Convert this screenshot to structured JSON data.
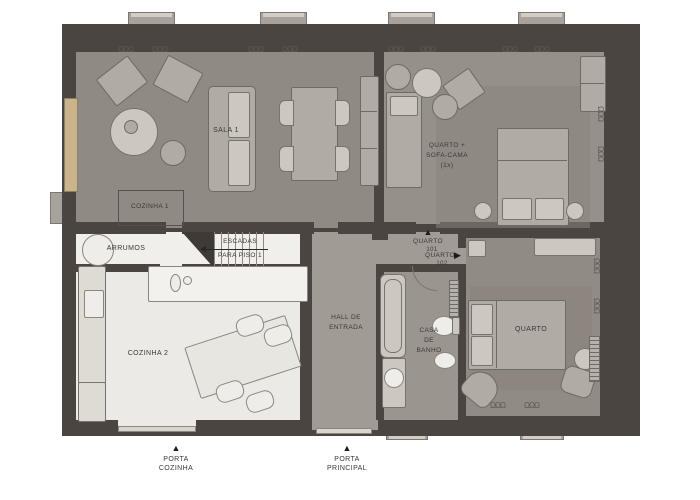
{
  "rooms": {
    "sala1": {
      "label": "SALA 1"
    },
    "cozinha1": {
      "label": "COZINHA 1"
    },
    "arrumos": {
      "label": "ARRUMOS"
    },
    "escadas": {
      "line1": "ESCADAS",
      "line2": "PARA PISO 1"
    },
    "cozinha2": {
      "label": "COZINHA 2"
    },
    "hall": {
      "line1": "HALL DE",
      "line2": "ENTRADA"
    },
    "banho": {
      "line1": "CASA",
      "line2": "DE",
      "line3": "BANHO"
    },
    "quarto_sofa": {
      "line1": "QUARTO +",
      "line2": "SOFA-CAMA",
      "line3": "(1x)"
    },
    "quarto2": {
      "label": "QUARTO"
    }
  },
  "doors": {
    "quarto101": {
      "line1": "QUARTO",
      "line2": "101",
      "arrow": "▲"
    },
    "quarto102": {
      "line1": "QUARTO",
      "line2": "102",
      "arrow": "▶"
    },
    "porta_cozinha": {
      "line1": "PORTA",
      "line2": "COZINHA",
      "arrow": "▲"
    },
    "porta_principal": {
      "line1": "PORTA",
      "line2": "PRINCIPAL",
      "arrow": "▲"
    }
  },
  "colors": {
    "wall": "#4a4541",
    "floor_gray": "#8f8a84",
    "floor_bedroom": "#95908a",
    "floor_hall": "#a09b95",
    "floor_bath": "#9a958e",
    "floor_kitchen2": "#eceae6",
    "floor_storage": "#f1efeb",
    "window_tint": "#c9b48c",
    "furniture": "#b0aca5",
    "label_text": "#3b3835"
  }
}
